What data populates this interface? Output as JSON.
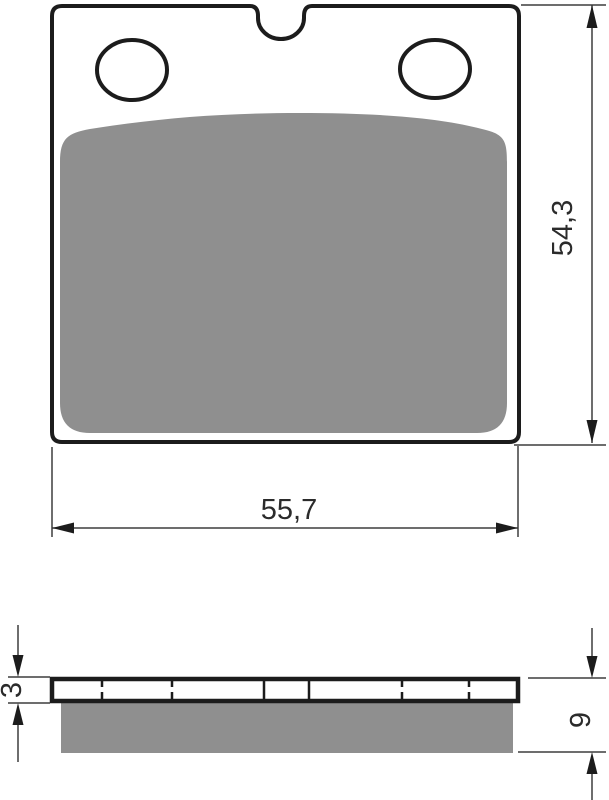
{
  "views": {
    "top": {
      "width_label": "55,7",
      "height_label": "54,3"
    },
    "side": {
      "plate_thickness_label": "3",
      "total_thickness_label": "9"
    }
  },
  "colors": {
    "outline": "#1c1c1c",
    "dim_line": "#3d3d3d",
    "friction_material": "#8f8f8f",
    "background": "#ffffff"
  }
}
